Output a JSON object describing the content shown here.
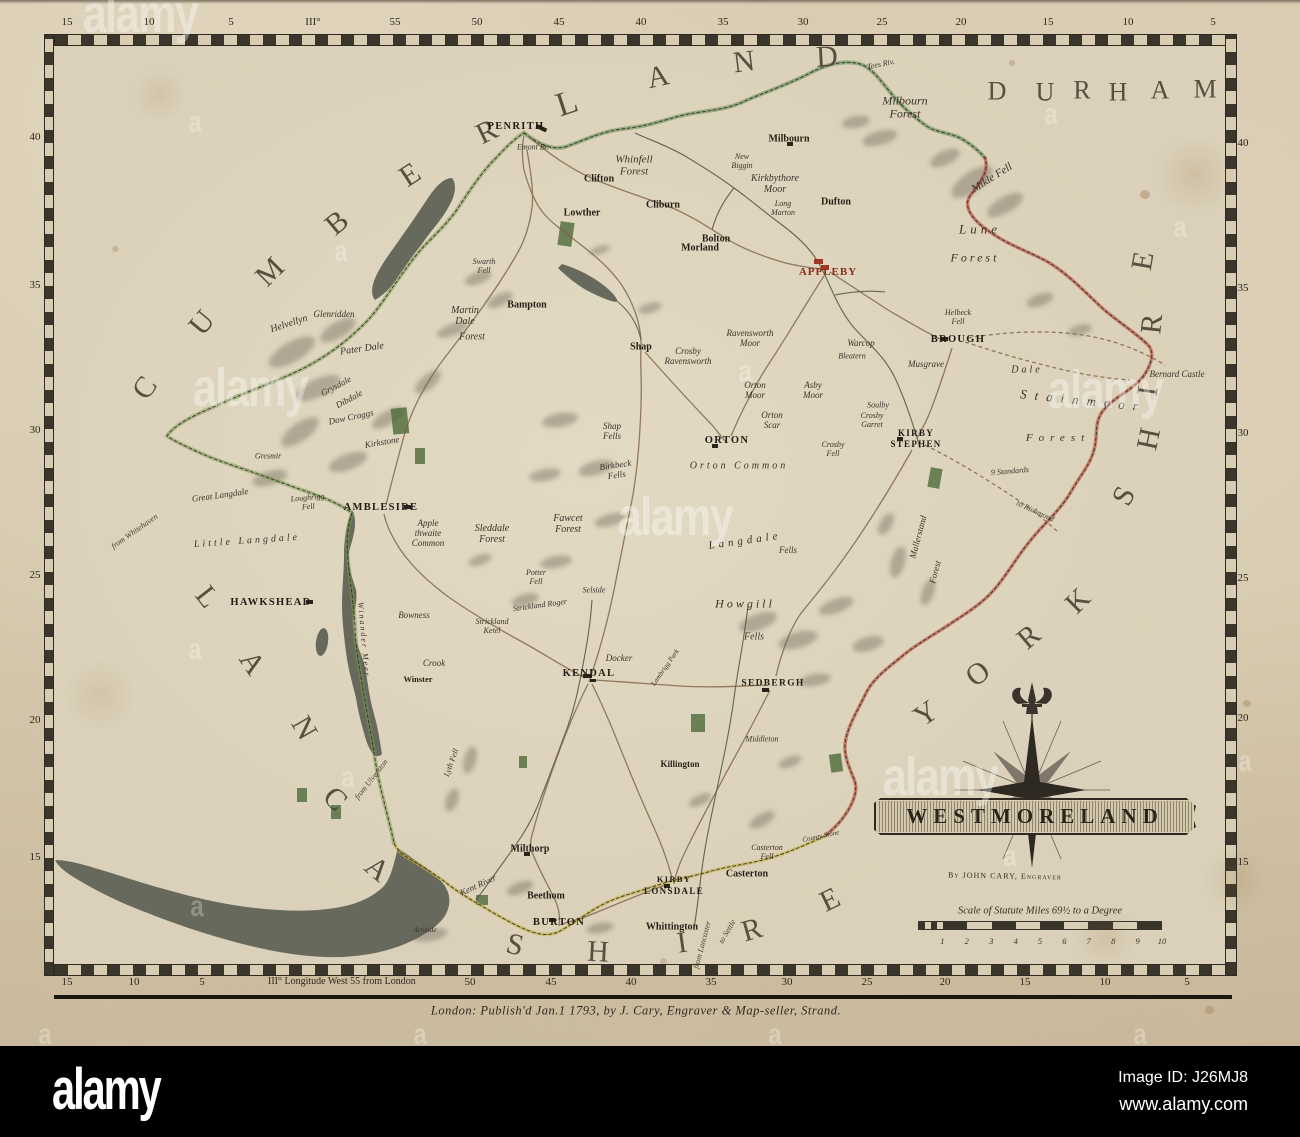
{
  "alamy_bar": {
    "logo": "alamy",
    "image_id": "Image ID: J26MJ8",
    "website": "www.alamy.com"
  },
  "watermark": {
    "word": "alamy",
    "letter": "a"
  },
  "map": {
    "title": "WESTMORELAND",
    "byline": "By JOHN CARY, Engraver",
    "scale_caption": "Scale of Statute Miles 69½ to a Degree",
    "scale_numbers": [
      "1",
      "2",
      "3",
      "4",
      "5",
      "6",
      "7",
      "8",
      "9",
      "10"
    ],
    "publication": "London: Publish'd Jan.1 1793, by J. Cary, Engraver & Map-seller, Strand.",
    "longitude_note": "III° Longitude West 55 from London",
    "graticule": {
      "top": [
        {
          "t": "15",
          "x": 67
        },
        {
          "t": "10",
          "x": 149
        },
        {
          "t": "5",
          "x": 231
        },
        {
          "t": "III°",
          "x": 313
        },
        {
          "t": "55",
          "x": 395
        },
        {
          "t": "50",
          "x": 477
        },
        {
          "t": "45",
          "x": 559
        },
        {
          "t": "40",
          "x": 641
        },
        {
          "t": "35",
          "x": 723
        },
        {
          "t": "30",
          "x": 803
        },
        {
          "t": "25",
          "x": 882
        },
        {
          "t": "20",
          "x": 961
        },
        {
          "t": "15",
          "x": 1048
        },
        {
          "t": "10",
          "x": 1128
        },
        {
          "t": "5",
          "x": 1213
        }
      ],
      "bottom": [
        {
          "t": "15",
          "x": 67
        },
        {
          "t": "10",
          "x": 134
        },
        {
          "t": "5",
          "x": 202
        },
        {
          "t": "50",
          "x": 470
        },
        {
          "t": "45",
          "x": 551
        },
        {
          "t": "40",
          "x": 631
        },
        {
          "t": "35",
          "x": 711
        },
        {
          "t": "30",
          "x": 787
        },
        {
          "t": "25",
          "x": 867
        },
        {
          "t": "20",
          "x": 945
        },
        {
          "t": "15",
          "x": 1025
        },
        {
          "t": "10",
          "x": 1105
        },
        {
          "t": "5",
          "x": 1187
        }
      ],
      "left": [
        {
          "t": "40",
          "y": 137
        },
        {
          "t": "35",
          "y": 285
        },
        {
          "t": "30",
          "y": 430
        },
        {
          "t": "25",
          "y": 575
        },
        {
          "t": "20",
          "y": 720
        },
        {
          "t": "15",
          "y": 857
        }
      ],
      "right": [
        {
          "t": "40",
          "y": 143
        },
        {
          "t": "35",
          "y": 288
        },
        {
          "t": "30",
          "y": 433
        },
        {
          "t": "25",
          "y": 578
        },
        {
          "t": "20",
          "y": 718
        },
        {
          "t": "15",
          "y": 862
        }
      ]
    },
    "labels": [
      {
        "t": "C",
        "x": 145,
        "y": 388,
        "c": "big",
        "r": -55,
        "n": "county-letter-cumberland"
      },
      {
        "t": "U",
        "x": 202,
        "y": 323,
        "c": "big",
        "r": -50,
        "n": "county-letter-cumberland"
      },
      {
        "t": "M",
        "x": 270,
        "y": 272,
        "c": "big",
        "r": -45,
        "n": "county-letter-cumberland"
      },
      {
        "t": "B",
        "x": 337,
        "y": 223,
        "c": "big",
        "r": -40,
        "n": "county-letter-cumberland"
      },
      {
        "t": "E",
        "x": 410,
        "y": 175,
        "c": "big",
        "r": -33,
        "n": "county-letter-cumberland"
      },
      {
        "t": "R",
        "x": 487,
        "y": 132,
        "c": "big",
        "r": -26,
        "n": "county-letter-cumberland"
      },
      {
        "t": "L",
        "x": 567,
        "y": 104,
        "c": "big",
        "r": -18,
        "s": 34,
        "n": "county-letter-cumberland"
      },
      {
        "t": "A",
        "x": 658,
        "y": 77,
        "c": "big",
        "r": -12,
        "n": "county-letter-cumberland"
      },
      {
        "t": "N",
        "x": 744,
        "y": 62,
        "c": "big",
        "r": -7,
        "n": "county-letter-cumberland"
      },
      {
        "t": "D",
        "x": 827,
        "y": 57,
        "c": "big",
        "r": -3,
        "n": "county-letter-cumberland"
      },
      {
        "t": "D",
        "x": 998,
        "y": 91,
        "c": "big2",
        "n": "county-letter-durham"
      },
      {
        "t": "U",
        "x": 1046,
        "y": 92,
        "c": "big2",
        "n": "county-letter-durham"
      },
      {
        "t": "R",
        "x": 1083,
        "y": 90,
        "c": "big2",
        "n": "county-letter-durham"
      },
      {
        "t": "H",
        "x": 1119,
        "y": 92,
        "c": "big2",
        "n": "county-letter-durham"
      },
      {
        "t": "A",
        "x": 1161,
        "y": 90,
        "c": "big2",
        "n": "county-letter-durham"
      },
      {
        "t": "M",
        "x": 1206,
        "y": 89,
        "c": "big2",
        "n": "county-letter-durham"
      },
      {
        "t": "Y",
        "x": 926,
        "y": 714,
        "c": "big",
        "r": -35,
        "n": "county-letter-yorkshire"
      },
      {
        "t": "O",
        "x": 978,
        "y": 674,
        "c": "big",
        "r": -38,
        "n": "county-letter-yorkshire"
      },
      {
        "t": "R",
        "x": 1029,
        "y": 637,
        "c": "big",
        "r": -40,
        "n": "county-letter-yorkshire"
      },
      {
        "t": "K",
        "x": 1078,
        "y": 601,
        "c": "big",
        "r": -45,
        "n": "county-letter-yorkshire"
      },
      {
        "t": "S",
        "x": 1124,
        "y": 496,
        "c": "big",
        "r": -62,
        "n": "county-letter-yorkshire"
      },
      {
        "t": "H",
        "x": 1149,
        "y": 439,
        "c": "big",
        "r": -78,
        "n": "county-letter-yorkshire"
      },
      {
        "t": "I",
        "x": 1148,
        "y": 391,
        "c": "big",
        "r": -82,
        "n": "county-letter-yorkshire"
      },
      {
        "t": "R",
        "x": 1152,
        "y": 324,
        "c": "big",
        "r": -84,
        "n": "county-letter-yorkshire"
      },
      {
        "t": "E",
        "x": 1143,
        "y": 261,
        "c": "big",
        "r": -80,
        "n": "county-letter-yorkshire"
      },
      {
        "t": "L",
        "x": 207,
        "y": 597,
        "c": "big",
        "r": 52,
        "n": "county-letter-lancashire"
      },
      {
        "t": "A",
        "x": 252,
        "y": 663,
        "c": "big",
        "r": 56,
        "n": "county-letter-lancashire"
      },
      {
        "t": "N",
        "x": 304,
        "y": 728,
        "c": "big",
        "r": 60,
        "n": "county-letter-lancashire"
      },
      {
        "t": "C",
        "x": 335,
        "y": 799,
        "c": "big",
        "r": 45,
        "n": "county-letter-lancashire"
      },
      {
        "t": "A",
        "x": 377,
        "y": 869,
        "c": "big",
        "r": 40,
        "n": "county-letter-lancashire"
      },
      {
        "t": "S",
        "x": 515,
        "y": 945,
        "c": "big",
        "r": 14,
        "n": "county-letter-lancashire"
      },
      {
        "t": "H",
        "x": 598,
        "y": 952,
        "c": "big",
        "r": 3,
        "n": "county-letter-lancashire"
      },
      {
        "t": "I",
        "x": 682,
        "y": 943,
        "c": "big",
        "r": -8,
        "n": "county-letter-lancashire"
      },
      {
        "t": "R",
        "x": 752,
        "y": 930,
        "c": "big",
        "r": -16,
        "n": "county-letter-lancashire"
      },
      {
        "t": "E",
        "x": 830,
        "y": 900,
        "c": "big",
        "r": -26,
        "n": "county-letter-lancashire"
      },
      {
        "t": "PENRITH",
        "x": 516,
        "y": 127,
        "c": "town"
      },
      {
        "t": "APPLEBY",
        "x": 828,
        "y": 272,
        "c": "red"
      },
      {
        "t": "BROUGH",
        "x": 958,
        "y": 340,
        "c": "town"
      },
      {
        "t": "KIRBY",
        "x": 916,
        "y": 433,
        "c": "town",
        "s": 9
      },
      {
        "t": "STEPHEN",
        "x": 916,
        "y": 444,
        "c": "town",
        "s": 9
      },
      {
        "t": "ORTON",
        "x": 727,
        "y": 441,
        "c": "town"
      },
      {
        "t": "AMBLESIDE",
        "x": 381,
        "y": 508,
        "c": "town"
      },
      {
        "t": "HAWKSHEAD",
        "x": 271,
        "y": 603,
        "c": "town"
      },
      {
        "t": "KENDAL",
        "x": 589,
        "y": 674,
        "c": "town"
      },
      {
        "t": "SEDBERGH",
        "x": 773,
        "y": 684,
        "c": "town",
        "s": 9.5
      },
      {
        "t": "BURTON",
        "x": 559,
        "y": 923,
        "c": "town"
      },
      {
        "t": "KIRBY",
        "x": 674,
        "y": 880,
        "c": "town",
        "s": 8.5
      },
      {
        "t": "LONSDALE",
        "x": 674,
        "y": 891,
        "c": "town",
        "s": 9
      },
      {
        "t": "Milthorp",
        "x": 530,
        "y": 849,
        "c": "town2"
      },
      {
        "t": "Beethom",
        "x": 546,
        "y": 896,
        "c": "town2"
      },
      {
        "t": "Whittington",
        "x": 672,
        "y": 927,
        "c": "town2"
      },
      {
        "t": "Casterton",
        "x": 747,
        "y": 874,
        "c": "town2"
      },
      {
        "t": "Milbourn",
        "x": 789,
        "y": 139,
        "c": "town2"
      },
      {
        "t": "Dufton",
        "x": 836,
        "y": 202,
        "c": "town2"
      },
      {
        "t": "Bolton",
        "x": 716,
        "y": 239,
        "c": "town2"
      },
      {
        "t": "Morland",
        "x": 700,
        "y": 248,
        "c": "town2"
      },
      {
        "t": "Bampton",
        "x": 527,
        "y": 305,
        "c": "town2"
      },
      {
        "t": "Shap",
        "x": 641,
        "y": 347,
        "c": "town2"
      },
      {
        "t": "Clifton",
        "x": 599,
        "y": 179,
        "c": "town2"
      },
      {
        "t": "Lowther",
        "x": 582,
        "y": 213,
        "c": "town2"
      },
      {
        "t": "Cliburn",
        "x": 663,
        "y": 205,
        "c": "town2"
      },
      {
        "t": "Winster",
        "x": 418,
        "y": 680,
        "c": "town2",
        "s": 8.5
      },
      {
        "t": "Crook",
        "x": 434,
        "y": 663,
        "c": "scr"
      },
      {
        "t": "Bowness",
        "x": 414,
        "y": 615,
        "c": "scr"
      },
      {
        "t": "Killington",
        "x": 680,
        "y": 764,
        "c": "town2",
        "s": 9
      },
      {
        "t": "Middleton",
        "x": 762,
        "y": 740,
        "c": "scr",
        "s": 8
      },
      {
        "t": "Emont Br.",
        "x": 533,
        "y": 148,
        "c": "scr",
        "s": 8
      },
      {
        "t": "Whinfell\nForest",
        "x": 634,
        "y": 166,
        "c": "scr",
        "s": 11
      },
      {
        "t": "Kirkbythore\nMoor",
        "x": 775,
        "y": 184,
        "c": "scr",
        "s": 10
      },
      {
        "t": "Milbourn\nForest",
        "x": 905,
        "y": 108,
        "c": "scr",
        "s": 12
      },
      {
        "t": "Mikle Fell",
        "x": 992,
        "y": 178,
        "c": "scr",
        "r": -32,
        "s": 11
      },
      {
        "t": "Lune",
        "x": 980,
        "y": 230,
        "c": "scr",
        "s": 13,
        "ls": 4
      },
      {
        "t": "Forest",
        "x": 975,
        "y": 258,
        "c": "scr",
        "s": 12,
        "ls": 3
      },
      {
        "t": "Tees Riv.",
        "x": 881,
        "y": 65,
        "c": "scr",
        "r": -12,
        "s": 8
      },
      {
        "t": "New\nBiggin",
        "x": 742,
        "y": 162,
        "c": "scr",
        "s": 8
      },
      {
        "t": "Long\nMarton",
        "x": 783,
        "y": 209,
        "c": "scr",
        "s": 8
      },
      {
        "t": "Martin\nDale",
        "x": 465,
        "y": 316,
        "c": "scr",
        "s": 10
      },
      {
        "t": "Forest",
        "x": 472,
        "y": 337,
        "c": "scr",
        "s": 10
      },
      {
        "t": "Helvellyn",
        "x": 289,
        "y": 324,
        "c": "scr",
        "r": -18,
        "s": 10
      },
      {
        "t": "Glenridden",
        "x": 334,
        "y": 314,
        "c": "scr"
      },
      {
        "t": "Pater Dale",
        "x": 362,
        "y": 349,
        "c": "scr",
        "r": -8,
        "s": 10
      },
      {
        "t": "Grysdale",
        "x": 336,
        "y": 386,
        "c": "scr",
        "r": -28
      },
      {
        "t": "Dibdale",
        "x": 349,
        "y": 399,
        "c": "scr",
        "r": -28
      },
      {
        "t": "Dow Craggs",
        "x": 351,
        "y": 417,
        "c": "scr",
        "r": -12
      },
      {
        "t": "Kirkstone",
        "x": 382,
        "y": 442,
        "c": "scr",
        "r": -10
      },
      {
        "t": "Swarth\nFell",
        "x": 484,
        "y": 267,
        "c": "scr",
        "s": 8
      },
      {
        "t": "Gresmir",
        "x": 268,
        "y": 457,
        "c": "scr",
        "s": 8
      },
      {
        "t": "Great Langdale",
        "x": 220,
        "y": 495,
        "c": "scr",
        "r": -8
      },
      {
        "t": "Little Langdale",
        "x": 247,
        "y": 541,
        "c": "scr",
        "r": -4,
        "s": 10,
        "ls": 3
      },
      {
        "t": "Loughrigg\nFell",
        "x": 308,
        "y": 503,
        "c": "scr",
        "r": -5,
        "s": 8
      },
      {
        "t": "from Whitehaven",
        "x": 135,
        "y": 532,
        "c": "note",
        "r": -35
      },
      {
        "t": "Winander Meer",
        "x": 363,
        "y": 640,
        "c": "scr",
        "r": 85,
        "s": 8,
        "ls": 2
      },
      {
        "t": "Apple\nthwaite\nCommon",
        "x": 428,
        "y": 533,
        "c": "scr"
      },
      {
        "t": "Sleddale\nForest",
        "x": 492,
        "y": 534,
        "c": "scr",
        "s": 10
      },
      {
        "t": "Strickland Roger",
        "x": 540,
        "y": 606,
        "c": "scr",
        "r": -8,
        "s": 8
      },
      {
        "t": "Strickland\nKetel",
        "x": 492,
        "y": 627,
        "c": "scr",
        "s": 8
      },
      {
        "t": "Potter\nFell",
        "x": 536,
        "y": 578,
        "c": "scr",
        "s": 8
      },
      {
        "t": "Selside",
        "x": 594,
        "y": 591,
        "c": "scr",
        "s": 8
      },
      {
        "t": "Docker",
        "x": 619,
        "y": 658,
        "c": "scr"
      },
      {
        "t": "Lyth Fell",
        "x": 452,
        "y": 763,
        "c": "scr",
        "r": -70,
        "s": 8
      },
      {
        "t": "Kent River",
        "x": 478,
        "y": 885,
        "c": "scr",
        "r": -25
      },
      {
        "t": "Arnside",
        "x": 425,
        "y": 930,
        "c": "scr",
        "s": 7.5
      },
      {
        "t": "from Ulverston",
        "x": 372,
        "y": 780,
        "c": "note",
        "r": -52
      },
      {
        "t": "from Lancaster",
        "x": 703,
        "y": 945,
        "c": "note",
        "r": -75
      },
      {
        "t": "to Settle",
        "x": 728,
        "y": 932,
        "c": "note",
        "r": -60
      },
      {
        "t": "to Richmond",
        "x": 1035,
        "y": 512,
        "c": "note",
        "r": 25
      },
      {
        "t": "Bernard Castle",
        "x": 1177,
        "y": 374,
        "c": "scr"
      },
      {
        "t": "Stainmoor",
        "x": 1083,
        "y": 401,
        "c": "scr",
        "r": 6,
        "s": 13,
        "ls": 8
      },
      {
        "t": "Forest",
        "x": 1058,
        "y": 438,
        "c": "scr",
        "s": 11,
        "ls": 6
      },
      {
        "t": "Dale",
        "x": 1027,
        "y": 370,
        "c": "scr",
        "s": 10,
        "ls": 3
      },
      {
        "t": "9 Standards",
        "x": 1010,
        "y": 472,
        "c": "scr",
        "r": -5,
        "s": 8
      },
      {
        "t": "Helbeck\nFell",
        "x": 958,
        "y": 318,
        "c": "scr",
        "s": 8
      },
      {
        "t": "Musgrave",
        "x": 926,
        "y": 364,
        "c": "scr"
      },
      {
        "t": "Soulby",
        "x": 878,
        "y": 406,
        "c": "scr",
        "s": 8
      },
      {
        "t": "Crosby\nGarret",
        "x": 872,
        "y": 421,
        "c": "scr",
        "s": 8
      },
      {
        "t": "Warcop",
        "x": 861,
        "y": 343,
        "c": "scr"
      },
      {
        "t": "Bleatern",
        "x": 852,
        "y": 357,
        "c": "scr",
        "s": 8
      },
      {
        "t": "Crosby\nRavensworth",
        "x": 688,
        "y": 356,
        "c": "scr"
      },
      {
        "t": "Ravensworth\nMoor",
        "x": 750,
        "y": 338,
        "c": "scr"
      },
      {
        "t": "Orton\nMoor",
        "x": 755,
        "y": 390,
        "c": "scr"
      },
      {
        "t": "Asby\nMoor",
        "x": 813,
        "y": 390,
        "c": "scr"
      },
      {
        "t": "Orton\nScar",
        "x": 772,
        "y": 420,
        "c": "scr"
      },
      {
        "t": "Orton Common",
        "x": 739,
        "y": 466,
        "c": "scr",
        "s": 10,
        "ls": 3
      },
      {
        "t": "Crosby\nFell",
        "x": 833,
        "y": 450,
        "c": "scr",
        "s": 8
      },
      {
        "t": "Shap\nFells",
        "x": 612,
        "y": 431,
        "c": "scr"
      },
      {
        "t": "Birkbeck\nFells",
        "x": 616,
        "y": 470,
        "c": "scr",
        "r": -8
      },
      {
        "t": "Fawcet\nForest",
        "x": 568,
        "y": 524,
        "c": "scr",
        "s": 10
      },
      {
        "t": "Langdale",
        "x": 745,
        "y": 541,
        "c": "scr",
        "r": -8,
        "s": 11,
        "ls": 4
      },
      {
        "t": "Fells",
        "x": 788,
        "y": 550,
        "c": "scr"
      },
      {
        "t": "Howgill",
        "x": 745,
        "y": 604,
        "c": "scr",
        "s": 12,
        "ls": 3
      },
      {
        "t": "Fells",
        "x": 754,
        "y": 637,
        "c": "scr",
        "s": 10
      },
      {
        "t": "Mallerstand",
        "x": 918,
        "y": 537,
        "c": "scr",
        "r": -75
      },
      {
        "t": "Forest",
        "x": 935,
        "y": 572,
        "c": "scr",
        "r": -75
      },
      {
        "t": "Lambrigg Park",
        "x": 666,
        "y": 668,
        "c": "scr",
        "r": -55,
        "s": 7
      },
      {
        "t": "Casterton\nFell",
        "x": 767,
        "y": 853,
        "c": "scr",
        "s": 8
      },
      {
        "t": "County Stone",
        "x": 821,
        "y": 837,
        "c": "scr",
        "r": -12,
        "s": 7
      }
    ]
  }
}
